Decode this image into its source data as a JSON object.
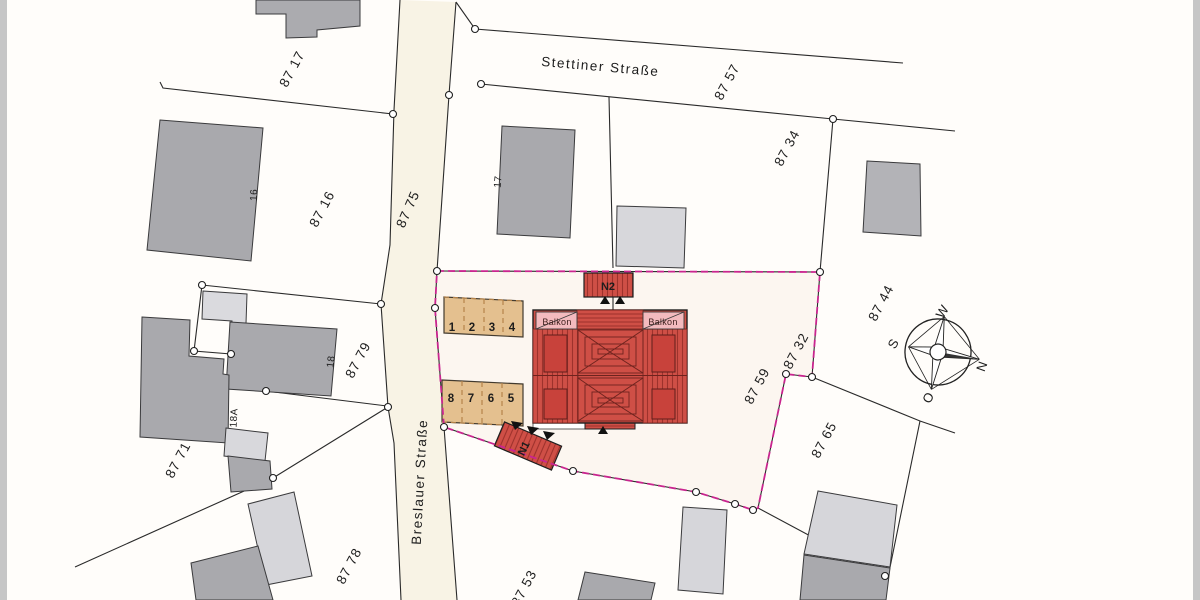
{
  "plan": {
    "streets": {
      "stettiner": "Stettiner Straße",
      "breslauer": "Breslauer Straße"
    },
    "parcels": {
      "p8717": "87 17",
      "p8757": "87 57",
      "p8716": "87 16",
      "p8775": "87 75",
      "p8734": "87 34",
      "p8744": "87 44",
      "p8779": "87 79",
      "p8759": "87 59",
      "p8732": "87 32",
      "p8765": "87 65",
      "p8771": "87 71",
      "p8778": "87 78",
      "p8753": "87 53"
    },
    "houses": {
      "h16": "16",
      "h17": "17",
      "h18": "18",
      "h18a": "18A"
    },
    "site": {
      "n1": "N1",
      "n2": "N2",
      "balkon": "Balkon",
      "parking_top": [
        "1",
        "2",
        "3",
        "4"
      ],
      "parking_bottom": [
        "8",
        "7",
        "6",
        "5"
      ]
    },
    "compass": {
      "w": "W",
      "s": "S",
      "o": "O",
      "n": "N"
    },
    "colors": {
      "boundary": "#c9258f",
      "roof_red": "#cf4f46",
      "roof_stripe": "#9e322c",
      "balcony_pink": "#f3babe",
      "parking_tan": "#e4c08f",
      "street_cream": "#f8f3e5",
      "building_gray": "#a9a9ad",
      "building_light": "#d6d6da"
    }
  }
}
